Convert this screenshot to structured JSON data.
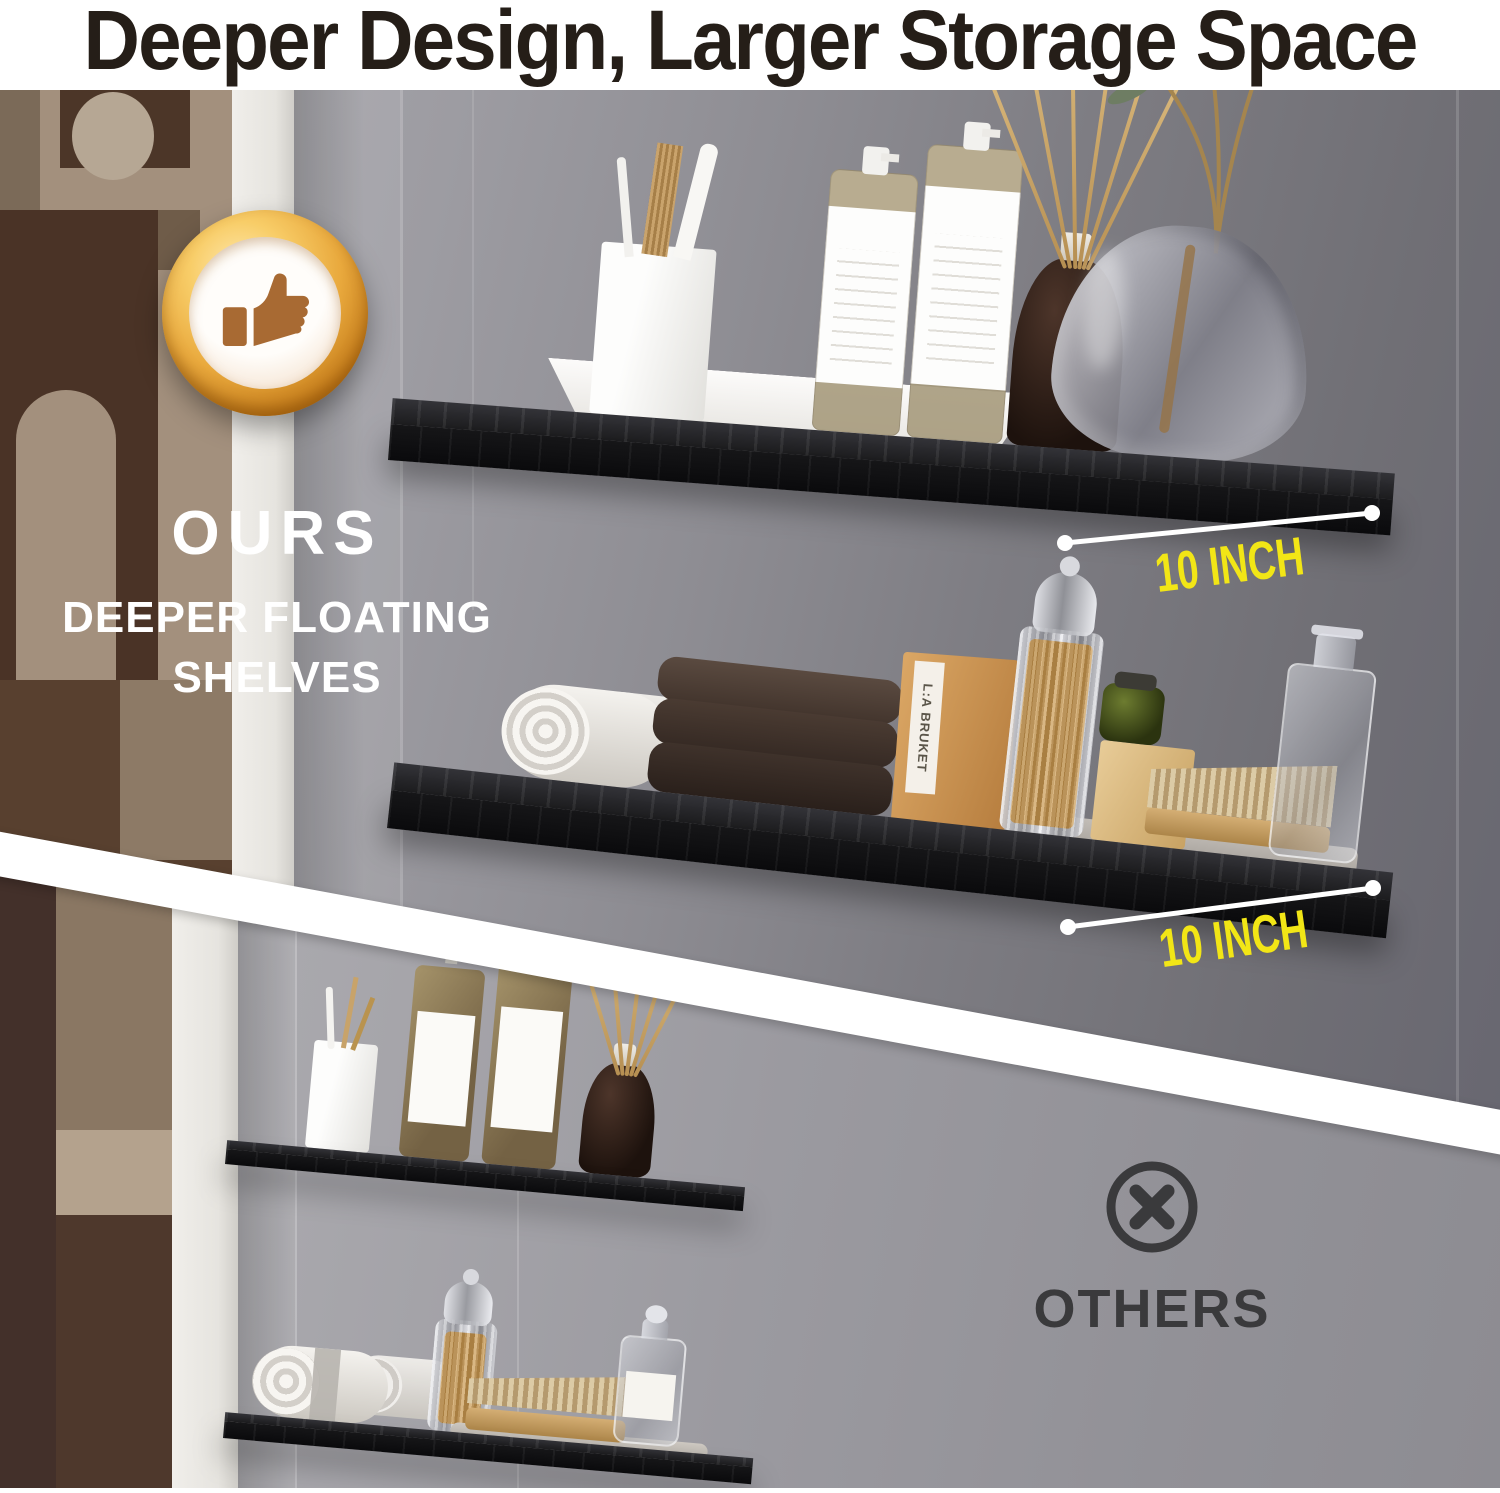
{
  "header": {
    "title": "Deeper Design, Larger Storage Space"
  },
  "ours": {
    "label": "OURS",
    "subtitle_line1": "DEEPER FLOATING",
    "subtitle_line2": "SHELVES",
    "badge_icon": "gold-thumbs-up-badge",
    "measurements": [
      {
        "label": "10 INCH"
      },
      {
        "label": "10 INCH"
      }
    ],
    "box_brand": "L:A BRUKET"
  },
  "others": {
    "label": "OTHERS",
    "icon": "circle-x"
  },
  "colors": {
    "accent_yellow": "#F2E616",
    "title_text": "#251E18",
    "label_white": "#FFFFFF",
    "others_dark": "#3A3A3C",
    "badge_gold": "#E2A33C",
    "shelf_black": "#18181A",
    "divider_white": "#FFFFFF"
  }
}
